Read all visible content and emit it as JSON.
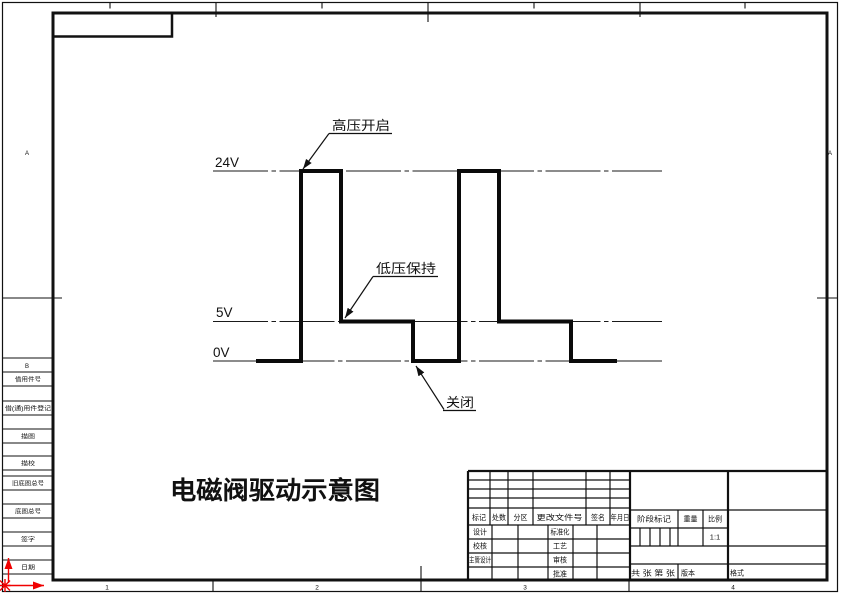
{
  "main_title": "电磁阀驱动示意图",
  "sheet": {
    "zone_numbers": [
      "1",
      "2",
      "3",
      "4"
    ],
    "zone_letters": [
      "A",
      "B"
    ]
  },
  "waveform": {
    "voltage_labels": [
      "24V",
      "5V",
      "0V"
    ],
    "points_px": "256,361 301,361 301,171 341,171 341,321.5 413,321.5 413,361 459,361 459,171 499,171 499,321.5 571,321.5 571,361 617,361",
    "annotations": [
      {
        "text": "高压开启"
      },
      {
        "text": "低压保持"
      },
      {
        "text": "关闭"
      }
    ]
  },
  "chart_data": {
    "type": "line",
    "title": "电磁阀驱动示意图",
    "y_tick_labels": [
      "24V",
      "5V",
      "0V"
    ],
    "levels_v": [
      24,
      5,
      0
    ],
    "voltage_sequence": [
      {
        "phase": "关闭",
        "voltage_v": 0
      },
      {
        "phase": "高压开启",
        "voltage_v": 24
      },
      {
        "phase": "低压保持",
        "voltage_v": 5
      },
      {
        "phase": "关闭",
        "voltage_v": 0
      },
      {
        "phase": "高压开启",
        "voltage_v": 24
      },
      {
        "phase": "低压保持",
        "voltage_v": 5
      },
      {
        "phase": "关闭",
        "voltage_v": 0
      }
    ],
    "annotations": [
      "高压开启",
      "低压保持",
      "关闭"
    ],
    "grid": false,
    "legend": false
  },
  "margin_column": {
    "items": [
      "借用件号",
      "借(通)用件登记",
      "描图",
      "描校",
      "旧底图总号",
      "底图总号",
      "签字",
      "日期"
    ]
  },
  "title_block": {
    "rev_header": [
      "标记",
      "处数",
      "分区",
      "更改文件号",
      "签名",
      "年月日"
    ],
    "left_labels": [
      "设计",
      "校核",
      "主管设计"
    ],
    "right_labels": [
      "标准化",
      "工艺",
      "审核",
      "批准"
    ],
    "stage_mark": "阶段标记",
    "weight": "重量",
    "scale": "比例",
    "scale_value": "1:1",
    "sheet_count": "共 张 第 张",
    "version": "版本",
    "format": "格式"
  }
}
